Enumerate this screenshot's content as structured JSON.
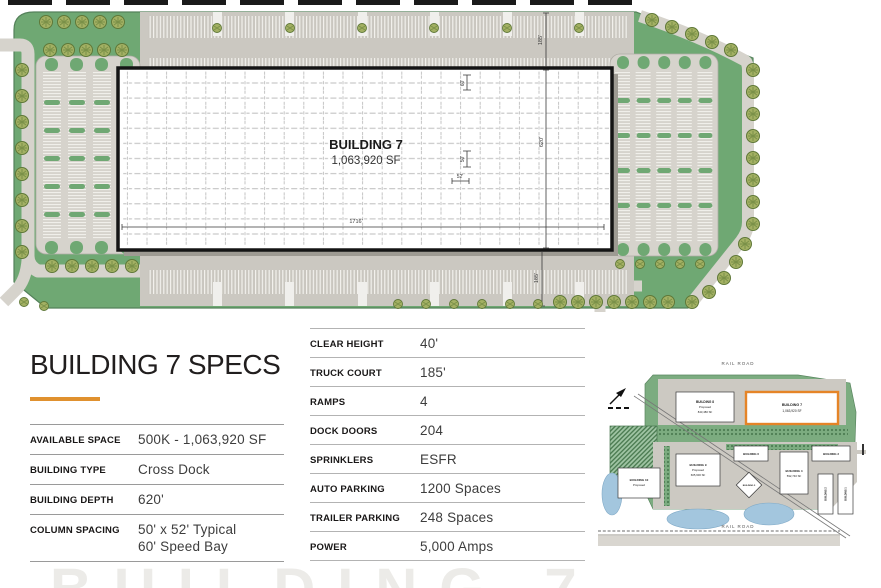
{
  "colors": {
    "accent_orange": "#E0912F",
    "site_green": "#6FA873",
    "parking_gray": "#D6D3CC",
    "pond_blue": "#A3C6DE",
    "minimap_highlight_orange": "#E58427"
  },
  "site_plan": {
    "building_name": "BUILDING 7",
    "building_sf": "1,063,920 SF",
    "dimensions": {
      "building_width": "1716'",
      "building_depth": "620'",
      "truck_court_top": "185'",
      "truck_court_bottom": "185'",
      "speed_bay": "60'",
      "column_bay_depth": "50'",
      "column_bay_width": "52'"
    }
  },
  "specs": {
    "title": "BUILDING 7 SPECS",
    "left_rows": [
      {
        "label": "AVAILABLE SPACE",
        "value": "500K - 1,063,920 SF"
      },
      {
        "label": "BUILDING TYPE",
        "value": "Cross Dock"
      },
      {
        "label": "BUILDING DEPTH",
        "value": "620'"
      },
      {
        "label": "COLUMN SPACING",
        "value": "50' x 52' Typical",
        "value2": "60' Speed Bay"
      }
    ],
    "right_rows": [
      {
        "label": "CLEAR HEIGHT",
        "value": "40'"
      },
      {
        "label": "TRUCK COURT",
        "value": "185'"
      },
      {
        "label": "RAMPS",
        "value": "4"
      },
      {
        "label": "DOCK DOORS",
        "value": "204"
      },
      {
        "label": "SPRINKLERS",
        "value": "ESFR"
      },
      {
        "label": "AUTO PARKING",
        "value": "1200 Spaces"
      },
      {
        "label": "TRAILER PARKING",
        "value": "248 Spaces"
      },
      {
        "label": "POWER",
        "value": "5,000 Amps"
      }
    ]
  },
  "minimap": {
    "railroad_top": "RAIL ROAD",
    "railroad_bottom": "RAIL ROAD",
    "buildings": [
      {
        "name": "BUILDING 8",
        "status": "Proposed",
        "sf": "843,480 SF"
      },
      {
        "name": "BUILDING 7",
        "sf": "1,063,920 SF"
      },
      {
        "name": "BUILDING 10",
        "status": "Proposed"
      },
      {
        "name": "BUILDING 9",
        "status": "Proposed",
        "sf": "605,600 SF"
      },
      {
        "name": "BUILDING 6"
      },
      {
        "name": "BUILDING 5"
      },
      {
        "name": "BUILDING 4",
        "sf": "592,740 SF"
      },
      {
        "name": "BUILDING 3"
      },
      {
        "name": "BUILDING 2"
      },
      {
        "name": "BUILDING 1"
      }
    ]
  },
  "watermark": {
    "text": "BUILDING 7"
  }
}
